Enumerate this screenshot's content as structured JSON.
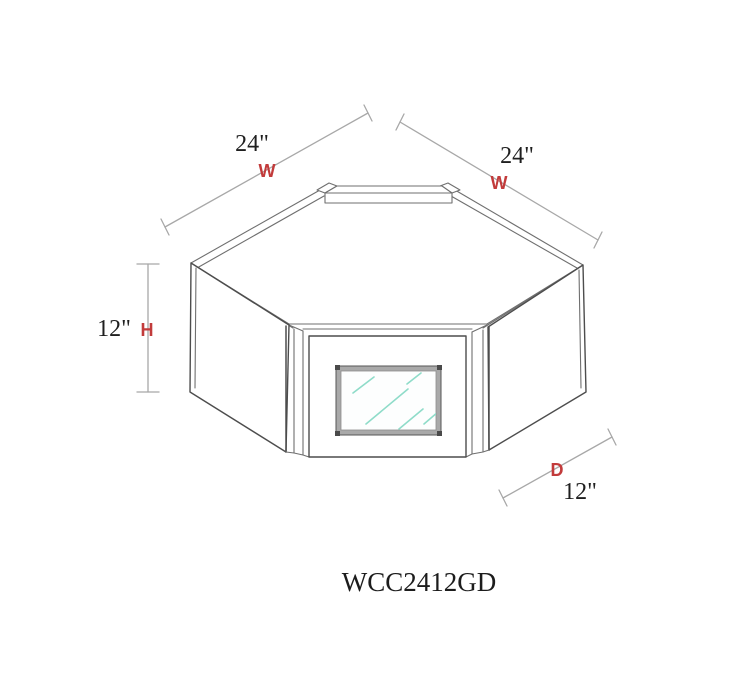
{
  "diagram": {
    "model_code": "WCC2412GD",
    "product_type_label": "wall-corner-cabinet-glass-door-diagram",
    "colors": {
      "background": "#ffffff",
      "line_gray": "#6f6f6f",
      "silhouette_gray": "#4d4d4d",
      "dimension_gray": "#a8a8a8",
      "label_red": "#c23b3b",
      "text_black": "#1f1f1f",
      "glass_streak_teal": "#8fdcc9",
      "glass_frame_gray": "#a9a9a9"
    },
    "dimensions": {
      "width_left": {
        "value": "24\"",
        "axis": "W"
      },
      "width_right": {
        "value": "24\"",
        "axis": "W"
      },
      "height": {
        "value": "12\"",
        "axis": "H"
      },
      "depth": {
        "value": "12\"",
        "axis": "D"
      }
    }
  }
}
